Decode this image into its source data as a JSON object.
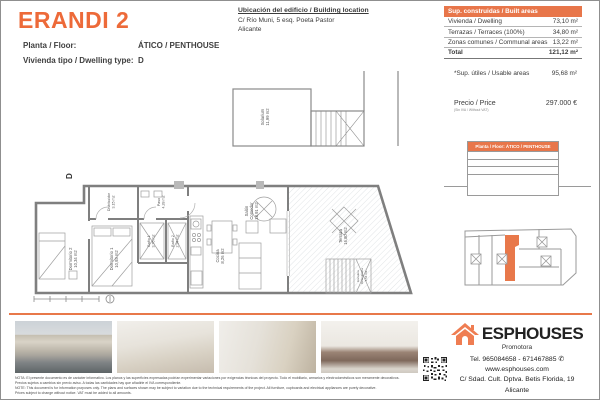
{
  "header": {
    "title": "ERANDI 2",
    "floor_label": "Planta / Floor:",
    "floor_value": "ÁTICO / PENTHOUSE",
    "type_label": "Vivienda tipo / Dwelling type:",
    "type_value": "D",
    "location_title": "Ubicación del edificio / Building location",
    "location_line1": "C/ Río Muni, 5 esq. Poeta Pastor",
    "location_line2": "Alicante"
  },
  "areas_table": {
    "header": "Sup. construidas / Built areas",
    "rows": [
      {
        "label": "Vivienda / Dwelling",
        "value": "73,10 m²"
      },
      {
        "label": "Terrazas / Terraces (100%)",
        "value": "34,80 m²"
      },
      {
        "label": "Zonas comunes / Communal areas",
        "value": "13,22 m²"
      }
    ],
    "total_label": "Total",
    "total_value": "121,12 m²",
    "usable_label": "*Sup. útiles / Usable areas",
    "usable_value": "95,68 m²",
    "price_label": "Precio / Price",
    "price_note": "(Sin IVA / Without VAT)",
    "price_value": "297.000 €"
  },
  "elevation_table": {
    "header": "Planta / Floor: ÁTICO / PENTHOUSE"
  },
  "floorplan": {
    "dwelling_mark": "D",
    "rooms": {
      "solarium": {
        "name": "Solarium",
        "area": "11,99 m2"
      },
      "distribuidor": {
        "name": "Distribuidor",
        "area": "3,15 m2"
      },
      "dormitorio2": {
        "name": "Dormitorio 2",
        "area": "10,34 m2"
      },
      "dormitorio1": {
        "name": "Dormitorio 1",
        "area": "10,93 m2"
      },
      "paso": {
        "name": "Paso",
        "area": "4,28 m2"
      },
      "bano1": {
        "name": "Baño 1",
        "area": "3,76 m2"
      },
      "bano2": {
        "name": "Baño 2",
        "area": "2,94 m2"
      },
      "cocina": {
        "name": "Cocina",
        "area": "8,26 m2"
      },
      "salon": {
        "name": "Salón",
        "name2": "Comedor",
        "area": "18,91 m2"
      },
      "terraza": {
        "name": "Terraza",
        "area": "16,80 m2"
      },
      "escalera": {
        "name": "Escalera",
        "name2": "Descubierta",
        "area": "4,54 m2"
      }
    }
  },
  "footer": {
    "note_es_1": "NOTA: El presente documento es de carácter informativo. Los planos y las superficies expresadas podrían experimentar variaciones por exigencias técnicas del proyecto. Todo el mobiliario, armarios y electrodomésticos son meramente decorativos.",
    "note_es_2": "Precios sujetos a cambios sin previo aviso. A todas las cantidades hay que añadirle el IVA correspondiente.",
    "note_en_1": "NOTE: This document is for information purposes only. The plans and surfaces shown may be subject to variation due to the technical requirements of the project. All furniture, cupboards and electrical appliances are purely decorative.",
    "note_en_2": "Prices subject to change without notice. VAT must be added to all amounts.",
    "brand": "ESPHOUSES",
    "brand_sub": "Promotora",
    "tel": "Tel. 965084658 - 671467885 ✆",
    "web": "www.esphouses.com",
    "address1": "C/ Sdad. Cult. Dptva. Betis Florida, 19",
    "address2": "Alicante"
  },
  "colors": {
    "accent": "#ed6a39",
    "table_header": "#e8764a",
    "logo_orange": "#ef7d52"
  }
}
